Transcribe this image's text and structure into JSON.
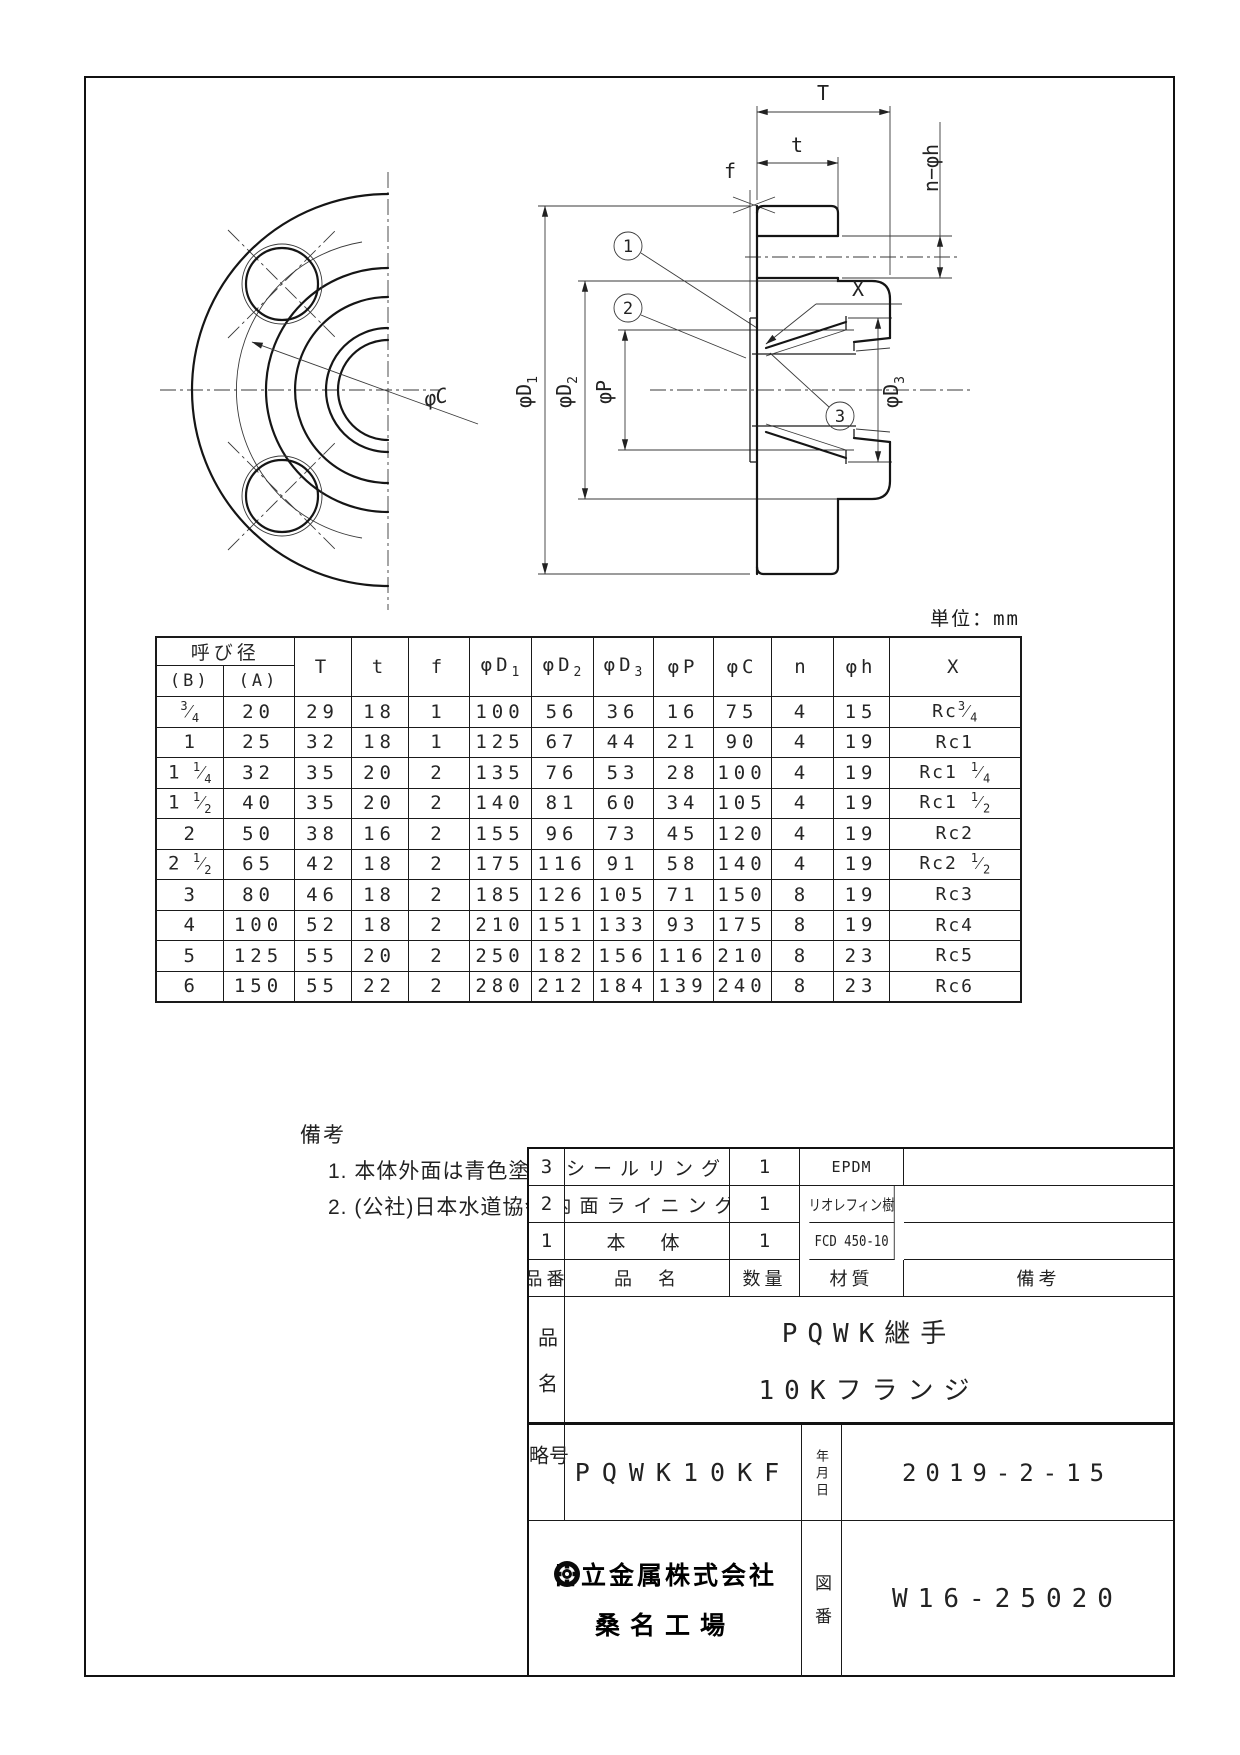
{
  "unit_label": "単位：mm",
  "drawing": {
    "labels": {
      "phiC": "φC",
      "T": "T",
      "t": "t",
      "f": "f",
      "X": "X",
      "n_phi_h": "n−φh",
      "phiP": "φP",
      "phiD1": {
        "base": "φD",
        "sub": "1"
      },
      "phiD2": {
        "base": "φD",
        "sub": "2"
      },
      "phiD3": {
        "base": "φD",
        "sub": "3"
      }
    },
    "balloons": [
      "1",
      "2",
      "3"
    ]
  },
  "dim_table": {
    "group_header": "呼び径",
    "sub_headers": [
      "(B)",
      "(A)"
    ],
    "columns": [
      {
        "base": "T"
      },
      {
        "base": "t"
      },
      {
        "base": "f"
      },
      {
        "base": "φD",
        "sub": "1"
      },
      {
        "base": "φD",
        "sub": "2"
      },
      {
        "base": "φD",
        "sub": "3"
      },
      {
        "base": "φP"
      },
      {
        "base": "φC"
      },
      {
        "base": "n"
      },
      {
        "base": "φh"
      },
      {
        "base": "X"
      }
    ],
    "rows": [
      [
        "3/4",
        "20",
        "29",
        "18",
        "1",
        "100",
        "56",
        "36",
        "16",
        "75",
        "4",
        "15",
        "Rc3/4"
      ],
      [
        "1",
        "25",
        "32",
        "18",
        "1",
        "125",
        "67",
        "44",
        "21",
        "90",
        "4",
        "19",
        "Rc1"
      ],
      [
        "1 1/4",
        "32",
        "35",
        "20",
        "2",
        "135",
        "76",
        "53",
        "28",
        "100",
        "4",
        "19",
        "Rc1 1/4"
      ],
      [
        "1 1/2",
        "40",
        "35",
        "20",
        "2",
        "140",
        "81",
        "60",
        "34",
        "105",
        "4",
        "19",
        "Rc1 1/2"
      ],
      [
        "2",
        "50",
        "38",
        "16",
        "2",
        "155",
        "96",
        "73",
        "45",
        "120",
        "4",
        "19",
        "Rc2"
      ],
      [
        "2 1/2",
        "65",
        "42",
        "18",
        "2",
        "175",
        "116",
        "91",
        "58",
        "140",
        "4",
        "19",
        "Rc2 1/2"
      ],
      [
        "3",
        "80",
        "46",
        "18",
        "2",
        "185",
        "126",
        "105",
        "71",
        "150",
        "8",
        "19",
        "Rc3"
      ],
      [
        "4",
        "100",
        "52",
        "18",
        "2",
        "210",
        "151",
        "133",
        "93",
        "175",
        "8",
        "19",
        "Rc4"
      ],
      [
        "5",
        "125",
        "55",
        "20",
        "2",
        "250",
        "182",
        "156",
        "116",
        "210",
        "8",
        "23",
        "Rc5"
      ],
      [
        "6",
        "150",
        "55",
        "22",
        "2",
        "280",
        "212",
        "184",
        "139",
        "240",
        "8",
        "23",
        "Rc6"
      ]
    ]
  },
  "notes": {
    "title": "備考",
    "items": [
      "1. 本体外面は青色塗装とする.",
      "2. (公社)日本水道協会品質認証センター認証登録品"
    ]
  },
  "title_block": {
    "parts_header": {
      "no": "品番",
      "name": "品　名",
      "qty": "数量",
      "material": "材質",
      "remark": "備考"
    },
    "parts": [
      {
        "no": "3",
        "name": "シールリング",
        "qty": "1",
        "material": "EPDM",
        "remark": ""
      },
      {
        "no": "2",
        "name": "内面ライニング",
        "qty": "1",
        "material": "ポリオレフィン樹脂",
        "remark": ""
      },
      {
        "no": "1",
        "name": "本　体",
        "qty": "1",
        "material": "FCD 450-10",
        "remark": ""
      }
    ],
    "product_name": {
      "label": "品名",
      "line1": "PQWK継手",
      "line2": "10Kフランジ"
    },
    "code": {
      "label": "略号",
      "value": "PQWK10KF"
    },
    "date": {
      "label": "年月日",
      "value": "2019-2-15"
    },
    "company": {
      "line1": "日立金属株式会社",
      "line2": "桑名工場"
    },
    "drawing_no": {
      "label": "図番",
      "value": "W16-25020"
    }
  }
}
